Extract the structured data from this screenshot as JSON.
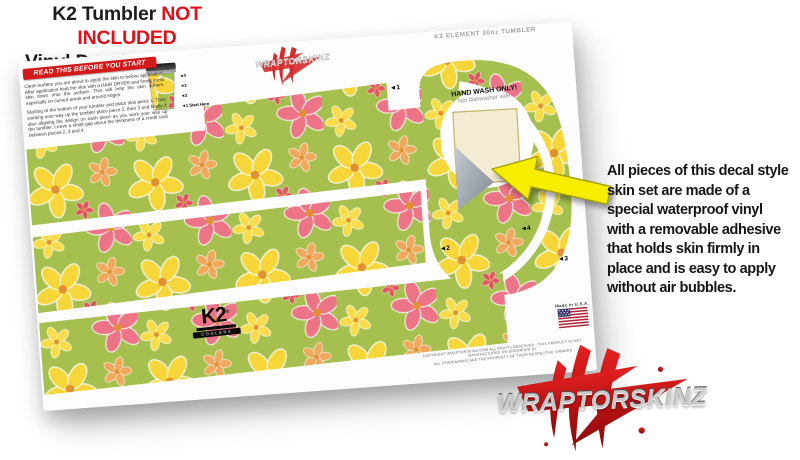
{
  "header": {
    "line1_black": "K2 Tumbler",
    "line1_red": "NOT INCLUDED",
    "line2": "Vinyl Decal Skin ONLY"
  },
  "sheet": {
    "top_label": "K2 ELEMENT 30oz TUMBLER",
    "watermark_text": "WRAPTORSKINZ",
    "read_banner": "READ THIS BEFORE YOU START",
    "instructions_para1": "Clean surface you are about to apply the skin to before application. After application heat the skin with a HAIR DRYER and firmly press skin down onto the surface. This will help the skin adhere, especially on curved areas and around edges.",
    "instructions_para2": "Starting at the bottom of your tumbler and place skin piece 1. Then working your way up the tumbler place piece 2, then 3 and finally 4 also aligning the design on each piece as you work your way up the tumbler. Leave a small gap about the thickness of a credit card between pieces 2, 3 and 4.",
    "guide_labels": [
      "◄4",
      "◄3",
      "◄2",
      "◄1 Start Here"
    ],
    "piece_labels": [
      "◄1",
      "◄2",
      "◄3",
      "◄4"
    ],
    "hand_wash_title": "HAND WASH ONLY!",
    "hand_wash_sub": "Not dishwasher safe.",
    "k2_logo_text": "K2",
    "k2_logo_reg": "®",
    "k2_logo_sub": "COOLERS",
    "made_in": "Made in U.S.A.",
    "fine_print_line1": "COPYRIGHT WRAPTORSKINZ.COM ALL RIGHTS RESERVED - THIS PRODUCT IS NOT MANUFACTURED OR ENDORSED BY",
    "fine_print_line2": "ALL TRADEMARKS ARE THE PROPERTY OF THEIR RESPECTIVE OWNERS"
  },
  "callout": {
    "text": "All pieces of this decal style\nskin set are made of a\nspecial waterproof vinyl\nwith a removable adhesive\nthat holds skin firmly in\nplace and is easy to apply\nwithout air bubbles."
  },
  "brand": {
    "logo_text": "WRAPTORSKINZ"
  },
  "colors": {
    "accent_red": "#e01118",
    "banner_red": "#d31a1a",
    "arrow_yellow": "#f7ed00",
    "pattern_green": "#a6c04f",
    "flower_yellow": "#f7d63a",
    "flower_pink": "#ec7486",
    "flower_orange": "#f0a85c",
    "logo_claw_red": "#d21b1b",
    "peel_backing": "#f3ecd2"
  }
}
